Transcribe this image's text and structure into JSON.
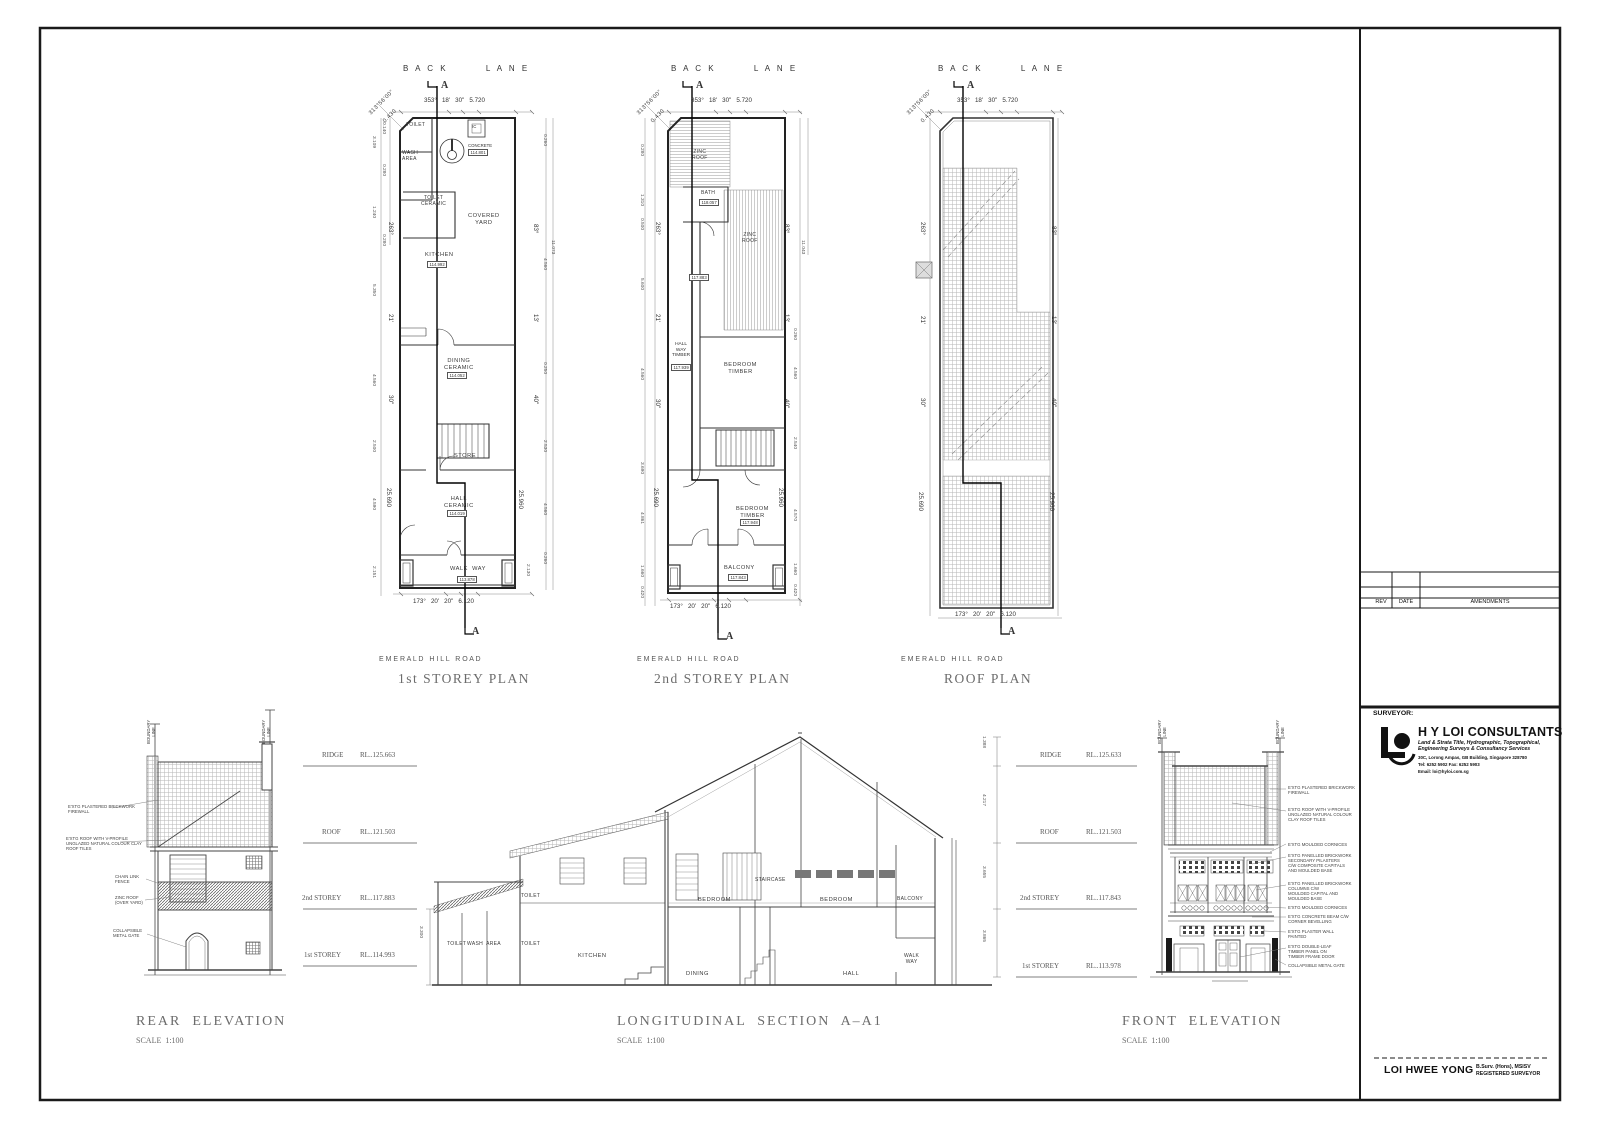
{
  "title_block": {
    "surveyor_label": "SURVEYOR:",
    "company": "H Y LOI CONSULTANTS",
    "services": "Land & Strata Title, Hydrographic, Topographical,\nEngineering Surveys & Consultancy Services",
    "address": "30C, Lorong Ampas, GB Building, Singapore 328780",
    "tel_fax": "Tel: 6252 5902   Fax: 6252 5903",
    "email": "Email: loi@hyloi.com.sg",
    "rev": "REV",
    "date": "DATE",
    "amendments": "AMENDMENTS",
    "surveyor_name": "LOI HWEE YONG",
    "credentials": "B.Surv. (Hons), MSISV\nREGISTERED SURVEYOR"
  },
  "labels": {
    "bl1": "B A C K        L A N E",
    "bl2": "B A C K        L A N E",
    "bl3": "B A C K        L A N E",
    "a1t": "A",
    "a1b": "A",
    "a2t": "A",
    "a2b": "A",
    "a3t": "A",
    "a3b": "A",
    "brg1a": "313°56'00\"",
    "brg1b": "0.430",
    "brg2a": "313°56'00\"",
    "brg2b": "0.430",
    "brg3a": "313°56'00\"",
    "brg3b": "0.430",
    "dt1": "353°   18'   30\"   5.720",
    "dt2": "353°   18'   30\"   5.720",
    "dt3": "353°   18'   30\"   5.720",
    "db1": "173°   20'   20\"   6.120",
    "db2": "173°   20'   20\"   6.120",
    "db3": "173°   20'   20\"   6.120",
    "road1": "E M E R A L D   H I L L   R O A D",
    "road2": "E M E R A L D   H I L L   R O A D",
    "road3": "E M E R A L D   H I L L   R O A D",
    "pt1": "1st STOREY PLAN",
    "pt2": "2nd STOREY PLAN",
    "pt3": "ROOF PLAN",
    "p1_toilet": "TOILET",
    "p1_wash": "WASH\nAREA",
    "p1_ic": "IC",
    "p1_conc": "CONCRETE",
    "p1_conc_v": "114.801",
    "p1_toil2": "TOILET\nCERAMIC",
    "p1_cy": "COVERED\nYARD",
    "p1_kit": "KITCHEN",
    "p1_kit_v": "114.992",
    "p1_din": "DINING\nCERAMIC",
    "p1_din_v": "114.052",
    "p1_store": "STORE",
    "p1_hall": "HALL\nCERAMIC",
    "p1_hall_v": "114.019",
    "p1_ww": "WALK  WAY",
    "p1_ww_v": "113.878",
    "l1a": "3.109",
    "l1b": "0.140",
    "l1c": "0.280",
    "l1d": "1.240",
    "l1e": "0.280",
    "l1f": "5.350",
    "l1g": "4.560",
    "l1h": "2.500",
    "l1i": "4.590",
    "l1j": "2.151",
    "b1a": "263°",
    "b1b": "21'",
    "b1c": "30\"",
    "b1d": "25.690",
    "b1e": "83°",
    "b1f": "13'",
    "b1g": "40\"",
    "b1h": "25.960",
    "r1a": "11.073",
    "r1b": "0.260",
    "r1c": "4.560",
    "r1d": "0.250",
    "r1e": "2.530",
    "r1f": "4.560",
    "r1g": "0.260",
    "r1h": "2.130",
    "p2_z1": "ZINC\nROOF",
    "p2_bath": "BATH",
    "p2_bath_v": "118.057",
    "p2_z2": "ZINC\nROOF",
    "p2_v883": "117.883",
    "p2_hw": "HALL\nWAY\nTIMBER",
    "p2_hw_v": "117.939",
    "p2_b1": "BEDROOM\nTIMBER",
    "p2_b2": "BEDROOM\nTIMBER",
    "p2_b2_v": "117.948",
    "p2_bal": "BALCONY",
    "p2_bal_v": "117.843",
    "l2a": "0.280",
    "l2b": "1.310",
    "l2c": "0.500",
    "l2d": "5.600",
    "l2e": "4.560",
    "l2f": "3.690",
    "l2g": "4.861",
    "l2h": "1.660",
    "l2i": "0.420",
    "b2a": "263°",
    "b2b": "21'",
    "b2c": "30\"",
    "b2d": "25.690",
    "b2e": "83°",
    "b2f": "13'",
    "b2g": "40\"",
    "b2h": "25.960",
    "r2a": "11.043",
    "r2b": "0.260",
    "r2c": "4.560",
    "r2d": "2.540",
    "r2e": "4.570",
    "r2f": "1.660",
    "r2g": "0.420",
    "b3a": "263°",
    "b3b": "21'",
    "b3c": "30\"",
    "b3d": "25.690",
    "b3e": "83°",
    "b3f": "13'",
    "b3g": "40\"",
    "b3h": "25.960",
    "rb1": "BOUNDARY\nLINE",
    "rb2": "BOUNDARY\nLINE",
    "fb1": "BOUNDARY\nLINE",
    "fb2": "BOUNDARY\nLINE",
    "ra1": "E'XTG PLASTERED BRICKWORK\nFIREWALL",
    "ra2": "E'XTG ROOF WITH V-PROFILE\nUNGLAZED NATURAL COLOUR CLAY\nROOF TILES",
    "ra3": "CHAIN LINK\nFENCE",
    "ra4": "ZINC ROOF\n(OVER YARD)",
    "ra5": "COLLAPSIBLE\nMETAL GATE",
    "sl1n": "RIDGE",
    "sl1v": "RL..125.663",
    "sl2n": "ROOF",
    "sl2v": "RL..121.503",
    "sl3n": "2nd STOREY",
    "sl3v": "RL..117.883",
    "sl4n": "1st STOREY",
    "sl4v": "RL..114.993",
    "sr1n": "RIDGE",
    "sr1v": "RL..125.633",
    "sr2n": "ROOF",
    "sr2v": "RL..121.503",
    "sr3n": "2nd STOREY",
    "sr3v": "RL..117.843",
    "sr4n": "1st STOREY",
    "sr4v": "RL..113.978",
    "d_r1": "1.388",
    "d_r2": "4.217",
    "d_r3": "3.655",
    "d_r4": "3.865",
    "sec_3300": "3.300",
    "sec_toilet1": "TOILET",
    "sec_wash": "WASH  AREA",
    "sec_toilet2": "TOILET",
    "sec_toilet3": "TOILET",
    "sec_kitchen": "KITCHEN",
    "sec_dining": "DINING",
    "sec_stair": "STAIRCASE",
    "sec_bed1": "BEDROOM",
    "sec_bed2": "BEDROOM",
    "sec_balc": "BALCONY",
    "sec_hall": "HALL",
    "sec_ww": "WALK\nWAY",
    "t_rear": "REAR  ELEVATION",
    "t_rear_s": "SCALE  1:100",
    "t_sec": "LONGITUDINAL  SECTION  A–A1",
    "t_sec_s": "SCALE  1:100",
    "t_front": "FRONT  ELEVATION",
    "t_front_s": "SCALE  1:100",
    "fa1": "E'XTG PLASTERED BRICKWORK\nFIREWALL",
    "fa2": "E'XTG ROOF WITH V-PROFILE\nUNGLAZED NATURAL COLOUR\nCLAY ROOF TILES",
    "fa3": "E'XTG MOULDED CORNICES",
    "fa4": "E'XTG PANELLED BRICKWORK\nSECONDARY PILASTERS\nC/W COMPOSITE CAPITALS\nAND MOULDED BASE",
    "fa5": "E'XTG PANELLED BRICKWORK\nCOLUMNS C/W\nMOULDED CAPITAL AND\nMOULDED BASE",
    "fa6": "E'XTG MOULDED CORNICES",
    "fa7": "E'XTG CONCRETE BEAM C/W\nCORNER BEVELLING",
    "fa8": "E'XTG PLASTER WALL\nPAINTED",
    "fa9": "E'XTG DOUBLE-LEAF\nTIMBER PANEL ON\nTIMBER FRAME DOOR",
    "fa10": "COLLAPSIBLE METAL GATE"
  }
}
